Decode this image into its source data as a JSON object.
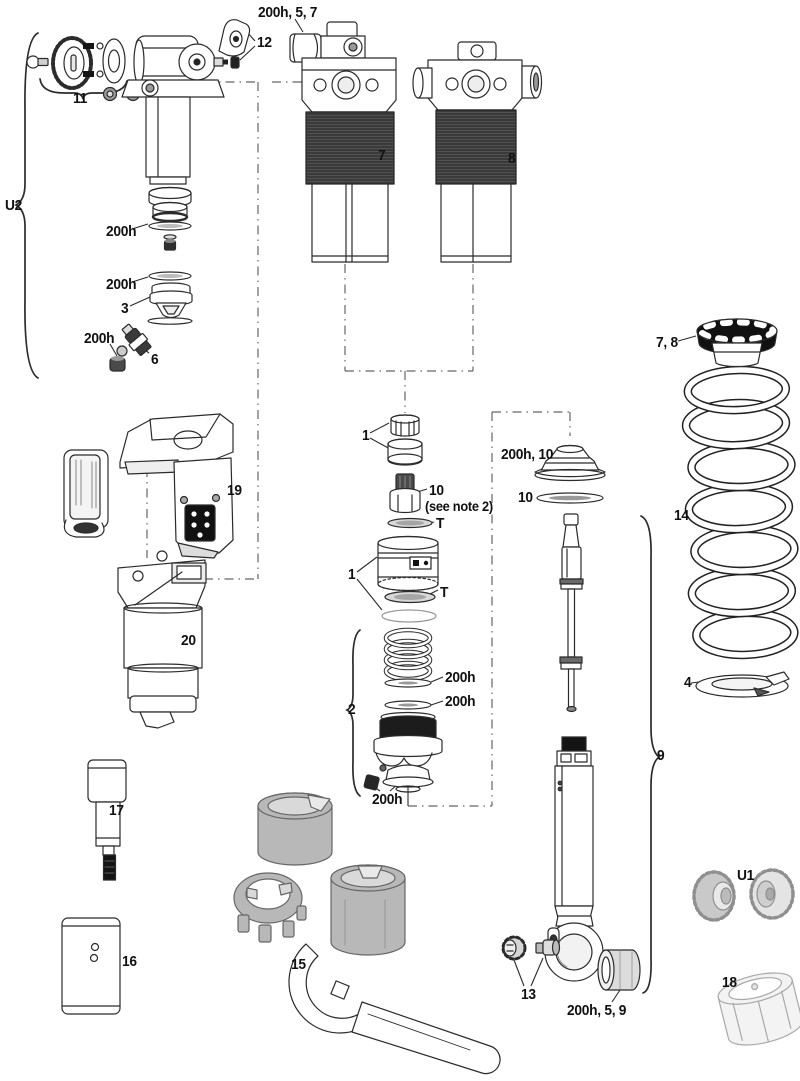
{
  "diagram": {
    "type": "exploded-parts-diagram",
    "colors": {
      "ink": "#2b2b2b",
      "dark_fill": "#1c1c1c",
      "can_fill": "#3a3a3a",
      "gray_fill": "#b8b8b8",
      "light_gray": "#e2e2e2",
      "background": "#ffffff"
    },
    "labels": {
      "top_bumper": "200h, 5, 7",
      "lever": "12",
      "knob_group": "11",
      "u2": "U2",
      "seal_a": "200h",
      "seal_b": "200h",
      "cap3": "3",
      "seal_c": "200h",
      "valve6": "6",
      "shock7": "7",
      "shock8": "8",
      "collar78": "7, 8",
      "spring14": "14",
      "seat4": "4",
      "one_a": "1",
      "ten_a": "10",
      "note2": "(see note 2)",
      "t_a": "T",
      "one_b": "1",
      "t_b": "T",
      "group2": "2",
      "seal_d": "200h",
      "seal_e": "200h",
      "seal_f": "200h",
      "sealhead": "200h, 10",
      "ten_b": "10",
      "module19": "19",
      "module20": "20",
      "damper9": "9",
      "tool17": "17",
      "block16": "16",
      "tools15": "15",
      "fittings13": "13",
      "bushing": "200h, 5, 9",
      "u1": "U1",
      "drum18": "18"
    }
  }
}
